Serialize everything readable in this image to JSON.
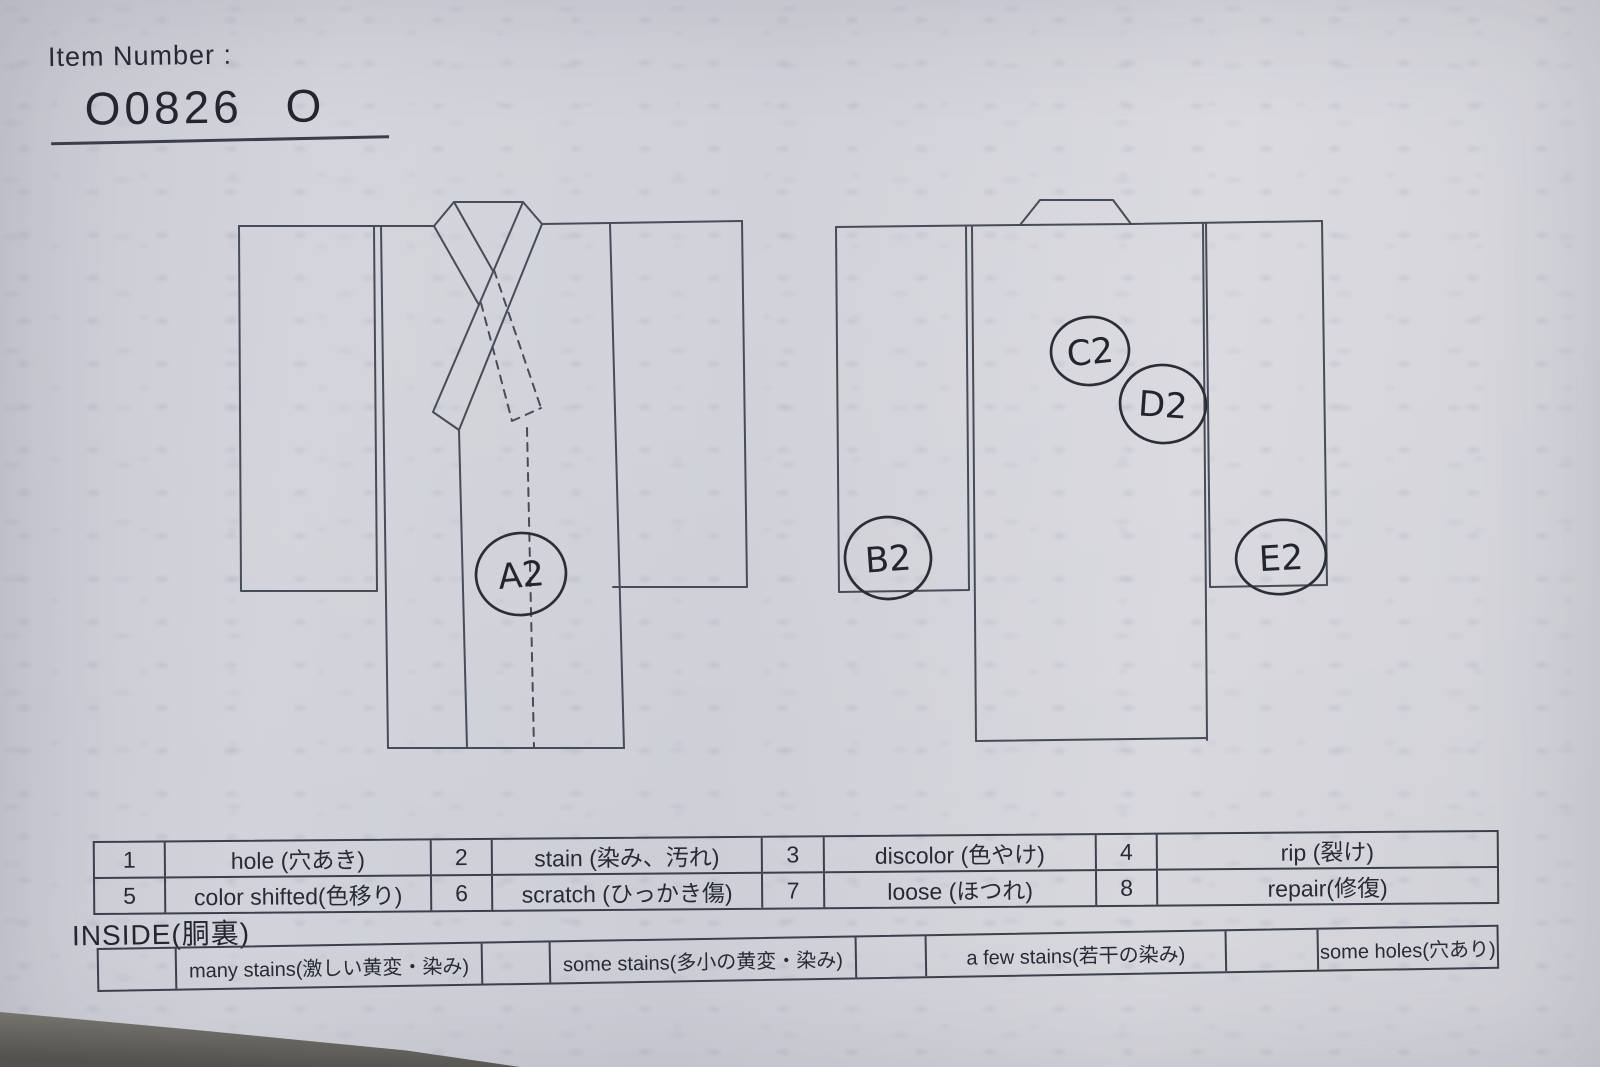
{
  "header": {
    "label": "Item Number :",
    "item_number": "O0826 O"
  },
  "annotations": {
    "a2": "A2",
    "b2": "B2",
    "c2": "C2",
    "d2": "D2",
    "e2": "E2"
  },
  "legend": {
    "cells": [
      {
        "num": "1",
        "label": "hole (穴あき)"
      },
      {
        "num": "2",
        "label": "stain (染み、汚れ)"
      },
      {
        "num": "3",
        "label": "discolor (色やけ)"
      },
      {
        "num": "4",
        "label": "rip (裂け)"
      },
      {
        "num": "5",
        "label": "color shifted(色移り)"
      },
      {
        "num": "6",
        "label": "scratch (ひっかき傷)"
      },
      {
        "num": "7",
        "label": "loose (ほつれ)"
      },
      {
        "num": "8",
        "label": "repair(修復)"
      }
    ]
  },
  "inside": {
    "label": "INSIDE(胴裏)",
    "options": [
      "many stains(激しい黄変・染み)",
      "some stains(多小の黄変・染み)",
      "a few stains(若干の染み)",
      "some holes(穴あり)"
    ]
  },
  "colors": {
    "paper": "#d0d1d8",
    "ink_lines": "#474c59",
    "handwriting": "#2b2e35",
    "text": "#272b35"
  }
}
